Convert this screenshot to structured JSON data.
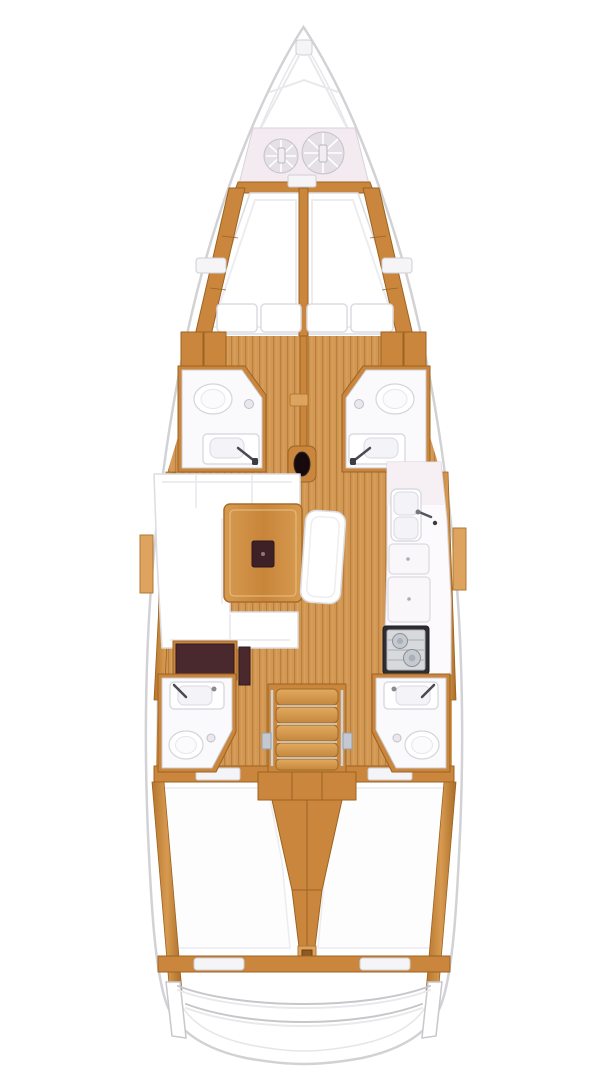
{
  "diagram": {
    "type": "sailboat-interior-floor-plan",
    "view": "top-down",
    "orientation": "bow-at-top",
    "colors": {
      "hull_outline": "#d2d2d6",
      "hull_inner_line": "#e6e6ea",
      "wood_mid": "#c9863c",
      "wood_dark": "#9c6322",
      "wood_light": "#dda35f",
      "floor_base": "#d29853",
      "floor_plank_line": "#b97f3c",
      "anchor_locker": "#f3ebf0",
      "rope_coil": "#e4e0e6",
      "white_furniture": "#ffffff",
      "dark_table_inset": "#3d2127",
      "nav_desk_dark": "#49282e",
      "stove_frame": "#2d2d33",
      "stove_top": "#d7d9dc",
      "steel": "#c4c8d0"
    },
    "areas": {
      "anchor_locker": {
        "name": "anchor locker",
        "rope_coils": 2
      },
      "forward_cabin": {
        "name": "forward V-berth cabin",
        "berths": 2,
        "pillows": 4
      },
      "forward_head_port": {
        "name": "forward head (port)",
        "fixtures": [
          "toilet",
          "washbasin",
          "shower-drain"
        ]
      },
      "forward_head_starboard": {
        "name": "forward head (starboard)",
        "fixtures": [
          "toilet",
          "washbasin",
          "shower-drain"
        ]
      },
      "mast": {
        "name": "mast post"
      },
      "saloon": {
        "name": "saloon",
        "furniture": [
          "u-shaped-settee",
          "dining-table",
          "island-bench",
          "chart-desk"
        ]
      },
      "galley": {
        "name": "galley",
        "fixtures": [
          "double-sink",
          "faucet",
          "worktop-lids",
          "two-burner-stove"
        ]
      },
      "companionway": {
        "name": "companionway steps",
        "steps": 5,
        "handrails": 2
      },
      "aft_head_port": {
        "name": "aft head (port)",
        "fixtures": [
          "washbasin",
          "toilet",
          "shower-drain"
        ]
      },
      "aft_head_starboard": {
        "name": "aft head (starboard)",
        "fixtures": [
          "washbasin",
          "toilet",
          "shower-drain"
        ]
      },
      "aft_cabin_port": {
        "name": "aft cabin (port)",
        "berths": 1
      },
      "aft_cabin_starboard": {
        "name": "aft cabin (starboard)",
        "berths": 1
      },
      "transom": {
        "name": "transom / swim platform",
        "curved_rails": 2
      }
    }
  }
}
